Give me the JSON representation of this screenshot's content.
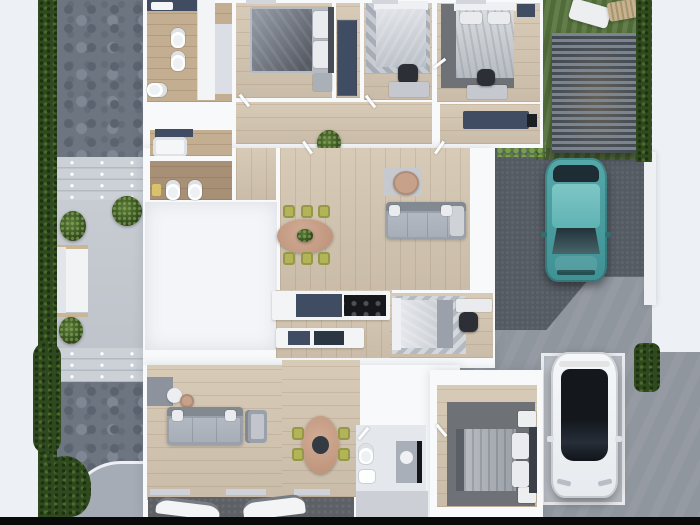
{
  "scene": {
    "description": "Top-down 3D architectural rendering of a residential floor plan with furnished rooms, landscaped yard, driveway and parked cars",
    "view": "overhead plan view",
    "has_visible_text": false
  },
  "colors": {
    "page_bg": "#edf0f5",
    "wall": "#f7f9fb",
    "wood": "#d4c6b1",
    "wood_warm": "#c4ae92",
    "hedge": "#2f4a1e",
    "lawn": "#57743c",
    "stone": "#6d7580",
    "patio": "#c3c8cf",
    "step_light": "#ccd1d7",
    "step_dark": "#b4bac2",
    "asphalt": "#555b63",
    "street": "#90969e",
    "pad": "#c9cdd3",
    "navy": "#3f4c61",
    "sofa_gray": "#9aa1ab",
    "sofa_light": "#b3b9c2",
    "pillow": "#e9ebee",
    "table_wood": "#c7a189",
    "chair_olive": "#b2b457",
    "teal_body": "#4aa3a4",
    "teal_roof": "#7fc6c6",
    "glass_dark": "#161b21",
    "white_car": "#f3f5f7",
    "rug_dark": "#6e7277",
    "rug_light": "#c6c9ce",
    "white_fixture": "#fdfefe",
    "garage": "#5d6166",
    "black_bar": "#0a0a0a"
  },
  "outdoor": {
    "left_yard": [
      "hedge row",
      "stone driveway",
      "entry steps",
      "concrete patio terrace",
      "white garden bench",
      "potted plants",
      "shrubs",
      "curved walkway"
    ],
    "right_yard": [
      "lawn",
      "white sun lounger",
      "wooden lounger",
      "slatted pergola canopy",
      "hedge rows",
      "asphalt driveway",
      "concrete parking pad",
      "street paving"
    ]
  },
  "house": {
    "rooms": [
      {
        "id": "bathroom-1",
        "label": "Bathroom with two toilets and vanity"
      },
      {
        "id": "bedroom-1",
        "label": "Bedroom with gray double bed"
      },
      {
        "id": "wardrobe-nook",
        "label": "Nook with navy wardrobe"
      },
      {
        "id": "bedroom-2",
        "label": "Bedroom with patterned rug, bed and desk"
      },
      {
        "id": "bedroom-3",
        "label": "Bedroom with bed on dark rug and desk"
      },
      {
        "id": "entry-room",
        "label": "Entry room with navy bench"
      },
      {
        "id": "hallway",
        "label": "Hallway with floor plant"
      },
      {
        "id": "bathroom-2",
        "label": "Bathroom with tub and two toilets"
      },
      {
        "id": "utility-room",
        "label": "Garage / utility room (empty, white)"
      },
      {
        "id": "living-dining",
        "label": "Living-dining room with oval table, six olive chairs, sofa and coffee table"
      },
      {
        "id": "kitchen",
        "label": "Kitchen with cooktop counter and island"
      },
      {
        "id": "bedroom-office",
        "label": "Bedroom/office with bed, desk and chair"
      },
      {
        "id": "living-2",
        "label": "Second living room with sofa, armchair and side tables"
      },
      {
        "id": "dining-2",
        "label": "Dining room with oval table and four olive chairs"
      },
      {
        "id": "bathroom-3",
        "label": "Bathroom with toilet, sink and vanity"
      },
      {
        "id": "bedroom-4",
        "label": "Bedroom with bed on dark rug and nightstands"
      },
      {
        "id": "garage",
        "label": "Garage with two parked cars (partially visible)"
      }
    ]
  },
  "vehicles": [
    {
      "id": "teal-car",
      "label": "Teal hatchback parked on asphalt driveway"
    },
    {
      "id": "white-car",
      "label": "White sedan parked on concrete pad"
    },
    {
      "id": "garage-car-1",
      "label": "White car inside garage (cut off at image edge)"
    },
    {
      "id": "garage-car-2",
      "label": "White car inside garage (cut off at image edge)"
    }
  ]
}
